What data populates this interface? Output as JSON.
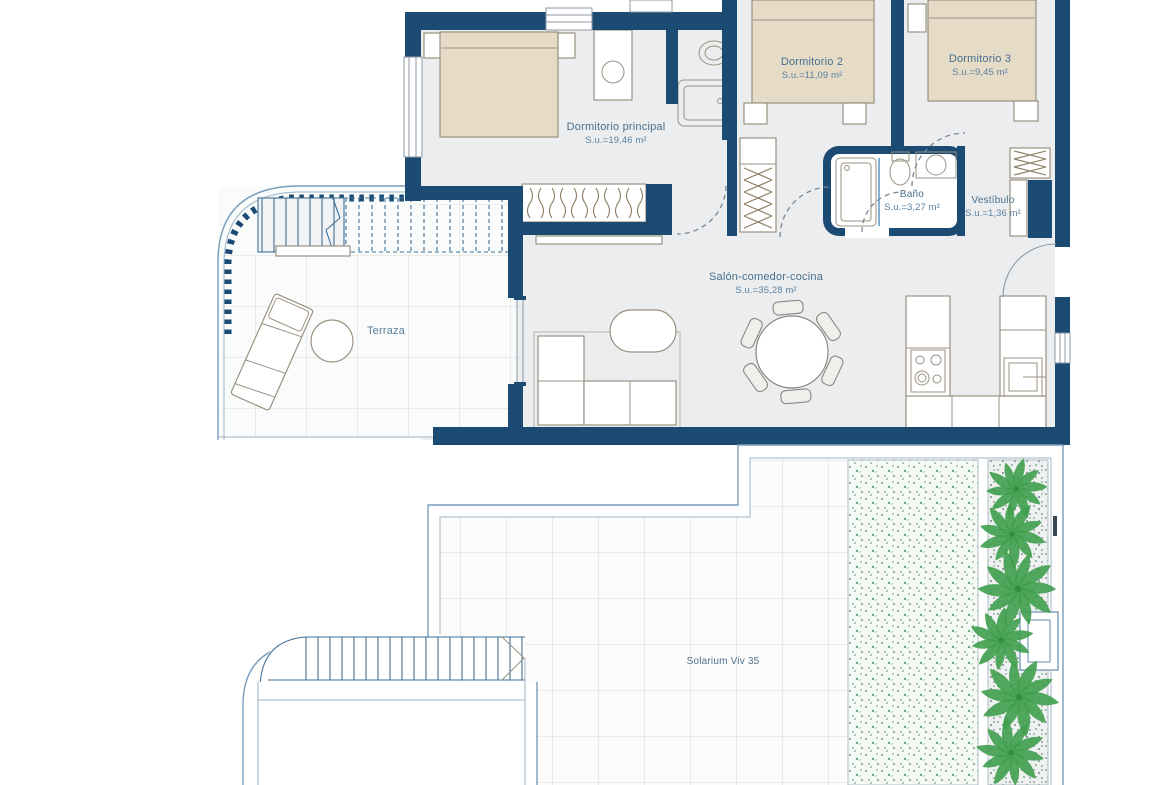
{
  "rooms": {
    "principal": {
      "name": "Dormitorio principal",
      "area": "S.u.=19,46 m²"
    },
    "dorm2": {
      "name": "Dormitorio 2",
      "area": "S.u.=11,09 m²"
    },
    "dorm3": {
      "name": "Dormitorio 3",
      "area": "S.u.=9,45 m²"
    },
    "bano": {
      "name": "Baño",
      "area": "S.u.=3,27 m²"
    },
    "vestibulo": {
      "name": "Vestíbulo",
      "area": "S.u.=1,36 m²"
    },
    "salon": {
      "name": "Salón-comedor-cocina",
      "area": "S.u.=35,28 m²"
    },
    "terraza": {
      "name": "Terraza"
    },
    "solarium": {
      "name": "Solarium Viv 35"
    }
  },
  "colors": {
    "wall": "#1b4b73",
    "bed": "#e6dbc6",
    "floor": "#ecedee",
    "outline": "#7a9cba",
    "palm": "#3f9e4c",
    "label_text": "#47708f"
  }
}
